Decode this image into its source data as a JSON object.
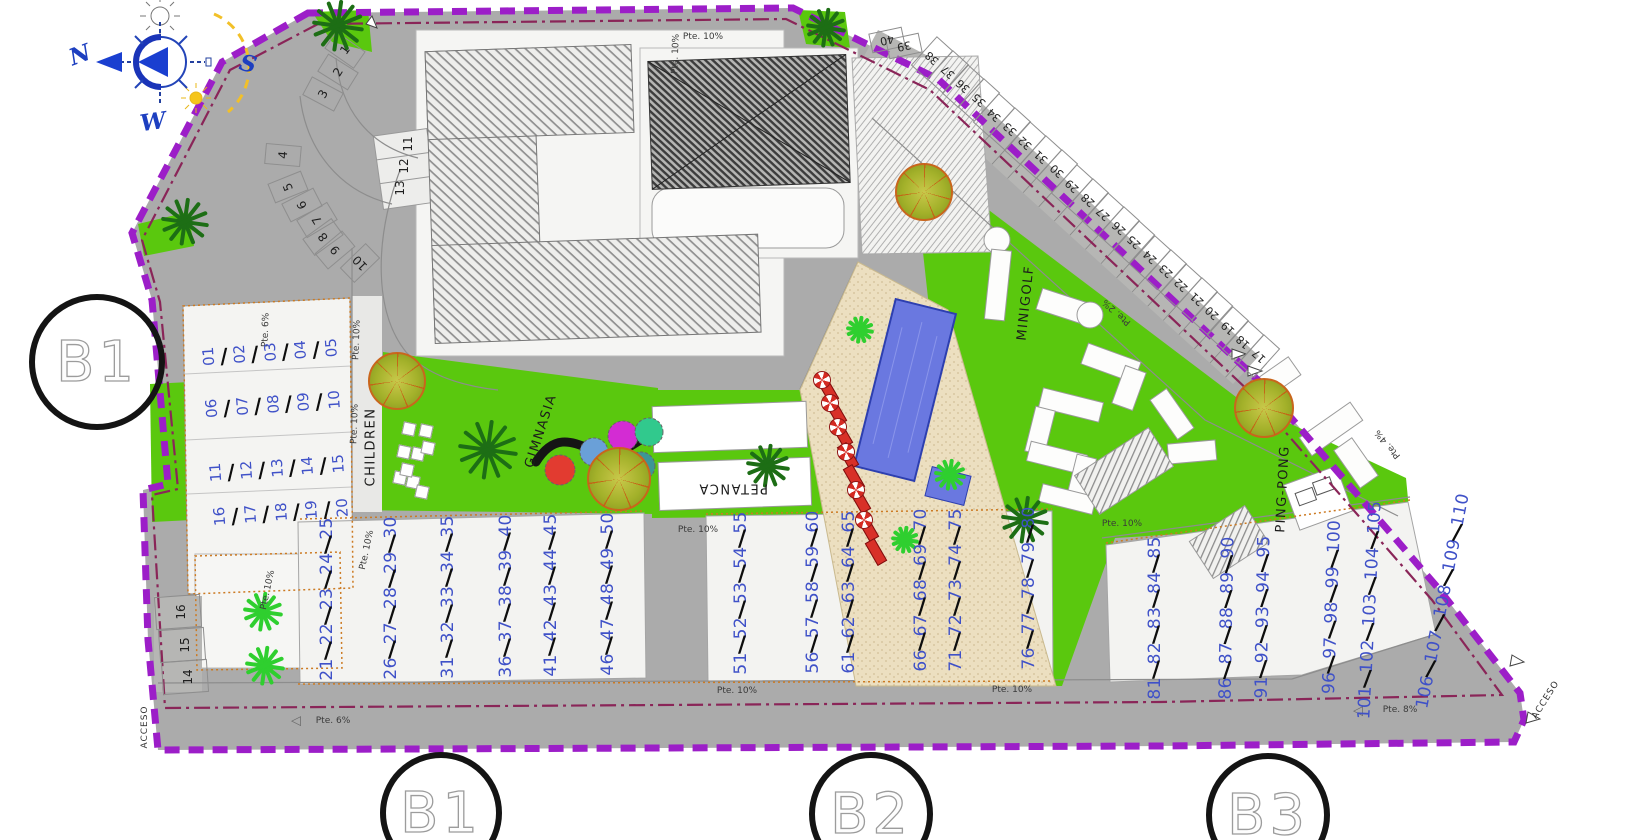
{
  "icons": {
    "slash": "/",
    "slope_arrow": "◁"
  },
  "colors": {
    "boundary": "#9c1ec8",
    "inner_line": "#8a2558",
    "numbers": "#3f51c8",
    "green": "#5ac80e",
    "road": "#ababab",
    "pool": "#6a78e0",
    "sand": "#ecdfc0",
    "accent_red": "#d83028"
  },
  "compass": {
    "letters": [
      {
        "text": "N",
        "x": 80,
        "y": 55,
        "rot": -20
      },
      {
        "text": "S",
        "x": 248,
        "y": 64,
        "rot": 15
      },
      {
        "text": "W",
        "x": 153,
        "y": 122,
        "rot": -8
      }
    ]
  },
  "block_circles": [
    {
      "label": "B1",
      "x": 97,
      "y": 362,
      "r": 62
    },
    {
      "label": "B1",
      "x": 441,
      "y": 813,
      "r": 55
    },
    {
      "label": "B2",
      "x": 871,
      "y": 814,
      "r": 56
    },
    {
      "label": "B3",
      "x": 1268,
      "y": 815,
      "r": 56
    }
  ],
  "area_labels": [
    {
      "text": "CHILDREN",
      "x": 371,
      "y": 447,
      "rot": -90
    },
    {
      "text": "GIMNASIA",
      "x": 541,
      "y": 431,
      "rot": -72
    },
    {
      "text": "PETANCA",
      "x": 733,
      "y": 488,
      "rot": 180
    },
    {
      "text": "MINIGOLF",
      "x": 1026,
      "y": 303,
      "rot": -84
    },
    {
      "text": "PING-PONG",
      "x": 1283,
      "y": 489,
      "rot": -87
    }
  ],
  "access_labels": [
    {
      "text": "ACCESO",
      "x": 145,
      "y": 727,
      "rot": -90
    },
    {
      "text": "ACCESO",
      "x": 1546,
      "y": 700,
      "rot": -58
    }
  ],
  "slope_labels": [
    {
      "text": "Pte. 6%",
      "x": 333,
      "y": 721,
      "rot": 0
    },
    {
      "text": "Pte. 8%",
      "x": 1400,
      "y": 710,
      "rot": 0
    },
    {
      "text": "Pte. 6%",
      "x": 266,
      "y": 330,
      "rot": -88
    },
    {
      "text": "Pte. 10%",
      "x": 676,
      "y": 54,
      "rot": -88
    },
    {
      "text": "Pte. 10%",
      "x": 703,
      "y": 37,
      "rot": 0
    },
    {
      "text": "Pte. 10%",
      "x": 357,
      "y": 340,
      "rot": -88
    },
    {
      "text": "Pte. 10%",
      "x": 355,
      "y": 424,
      "rot": -88
    },
    {
      "text": "Pte. 10%",
      "x": 268,
      "y": 590,
      "rot": -78
    },
    {
      "text": "Pte. 10%",
      "x": 367,
      "y": 550,
      "rot": -78
    },
    {
      "text": "Pte. 10%",
      "x": 698,
      "y": 530,
      "rot": 0
    },
    {
      "text": "Pte. 10%",
      "x": 1122,
      "y": 524,
      "rot": 0
    },
    {
      "text": "Pte. 10%",
      "x": 737,
      "y": 691,
      "rot": 0
    },
    {
      "text": "Pte. 10%",
      "x": 1012,
      "y": 690,
      "rot": 0
    },
    {
      "text": "Pte. 2%",
      "x": 1117,
      "y": 312,
      "rot": -138
    },
    {
      "text": "Pte. 4%",
      "x": 1388,
      "y": 444,
      "rot": -130
    }
  ],
  "slope_arrows": [
    {
      "x": 296,
      "y": 721,
      "rot": 0
    },
    {
      "x": 1358,
      "y": 711,
      "rot": 0
    }
  ],
  "left_building_rows": [
    {
      "nums": [
        "01",
        "02",
        "03",
        "04",
        "05"
      ],
      "x": 270,
      "y": 353,
      "rot": -4
    },
    {
      "nums": [
        "06",
        "07",
        "08",
        "09",
        "10"
      ],
      "x": 273,
      "y": 405,
      "rot": -4
    },
    {
      "nums": [
        "11",
        "12",
        "13",
        "14",
        "15"
      ],
      "x": 277,
      "y": 469,
      "rot": -4
    },
    {
      "nums": [
        "16",
        "17",
        "18",
        "19",
        "20"
      ],
      "x": 281,
      "y": 513,
      "rot": -4
    }
  ],
  "bottom_unit_groups": [
    {
      "nums": [
        "21",
        "22",
        "23",
        "24",
        "25"
      ],
      "x": 327,
      "y": 599,
      "rot": -90
    },
    {
      "nums": [
        "26",
        "27",
        "28",
        "29",
        "30"
      ],
      "x": 391,
      "y": 598,
      "rot": -90
    },
    {
      "nums": [
        "31",
        "32",
        "33",
        "34",
        "35"
      ],
      "x": 448,
      "y": 597,
      "rot": -90
    },
    {
      "nums": [
        "36",
        "37",
        "38",
        "39",
        "40"
      ],
      "x": 506,
      "y": 596,
      "rot": -90
    },
    {
      "nums": [
        "41",
        "42",
        "43",
        "44",
        "45"
      ],
      "x": 551,
      "y": 595,
      "rot": -90
    },
    {
      "nums": [
        "46",
        "47",
        "48",
        "49",
        "50"
      ],
      "x": 608,
      "y": 594,
      "rot": -90
    },
    {
      "nums": [
        "51",
        "52",
        "53",
        "54",
        "55"
      ],
      "x": 741,
      "y": 593,
      "rot": -90
    },
    {
      "nums": [
        "56",
        "57",
        "58",
        "59",
        "60"
      ],
      "x": 813,
      "y": 592,
      "rot": -90
    },
    {
      "nums": [
        "61",
        "62",
        "63",
        "64",
        "65"
      ],
      "x": 849,
      "y": 592,
      "rot": -90
    },
    {
      "nums": [
        "66",
        "67",
        "68",
        "69",
        "70"
      ],
      "x": 921,
      "y": 590,
      "rot": -90
    },
    {
      "nums": [
        "71",
        "72",
        "73",
        "74",
        "75"
      ],
      "x": 956,
      "y": 590,
      "rot": -90
    },
    {
      "nums": [
        "76",
        "77",
        "78",
        "79",
        "80"
      ],
      "x": 1029,
      "y": 588,
      "rot": -90
    },
    {
      "nums": [
        "81",
        "82",
        "83",
        "84",
        "85"
      ],
      "x": 1155,
      "y": 618,
      "rot": -90
    },
    {
      "nums": [
        "86",
        "87",
        "88",
        "89",
        "90"
      ],
      "x": 1227,
      "y": 618,
      "rot": -89
    },
    {
      "nums": [
        "91",
        "92",
        "93",
        "94",
        "95"
      ],
      "x": 1263,
      "y": 617,
      "rot": -89
    },
    {
      "nums": [
        "96",
        "97",
        "98",
        "99",
        "100"
      ],
      "x": 1332,
      "y": 607,
      "rot": -88
    },
    {
      "nums": [
        "101",
        "102",
        "103",
        "104",
        "105"
      ],
      "x": 1370,
      "y": 610,
      "rot": -87
    },
    {
      "nums": [
        "106",
        "107",
        "108",
        "109",
        "110"
      ],
      "x": 1443,
      "y": 601,
      "rot": -79
    }
  ],
  "parking": {
    "curve": [
      {
        "n": "1",
        "x": 345,
        "y": 50,
        "rot": -55
      },
      {
        "n": "2",
        "x": 338,
        "y": 72,
        "rot": -58
      },
      {
        "n": "3",
        "x": 323,
        "y": 94,
        "rot": -62
      },
      {
        "n": "4",
        "x": 283,
        "y": 155,
        "rot": -85
      },
      {
        "n": "5",
        "x": 288,
        "y": 187,
        "rot": -112
      },
      {
        "n": "6",
        "x": 302,
        "y": 205,
        "rot": -117
      },
      {
        "n": "7",
        "x": 317,
        "y": 220,
        "rot": -121
      },
      {
        "n": "8",
        "x": 323,
        "y": 237,
        "rot": -126
      },
      {
        "n": "9",
        "x": 335,
        "y": 250,
        "rot": -130
      },
      {
        "n": "10",
        "x": 360,
        "y": 263,
        "rot": -134
      }
    ],
    "island": [
      {
        "n": "11",
        "x": 408,
        "y": 144
      },
      {
        "n": "12",
        "x": 404,
        "y": 166
      },
      {
        "n": "13",
        "x": 400,
        "y": 188
      }
    ],
    "corner": [
      {
        "n": "16",
        "x": 181,
        "y": 612
      },
      {
        "n": "15",
        "x": 185,
        "y": 645
      },
      {
        "n": "14",
        "x": 188,
        "y": 677
      }
    ],
    "diagonal": {
      "nums": [
        "17",
        "18",
        "19",
        "20",
        "21",
        "22",
        "23",
        "24",
        "25",
        "26",
        "27",
        "28",
        "29",
        "30",
        "31",
        "32",
        "33",
        "34",
        "35",
        "36",
        "37",
        "38"
      ],
      "x0": 1259,
      "y0": 356,
      "dx": -15.57,
      "dy": -14.2,
      "rot": -138,
      "cell_rot": 42
    },
    "diagonal_extra": [
      {
        "n": "39",
        "x": 904,
        "y": 46,
        "rot": 168
      },
      {
        "n": "40",
        "x": 887,
        "y": 40,
        "rot": 168
      }
    ]
  },
  "landscape": {
    "trees": [
      {
        "x": 397,
        "y": 381,
        "r": 27
      },
      {
        "x": 619,
        "y": 479,
        "r": 30
      },
      {
        "x": 924,
        "y": 192,
        "r": 27
      },
      {
        "x": 1264,
        "y": 408,
        "r": 28
      }
    ],
    "palms_dark": [
      {
        "x": 338,
        "y": 26,
        "r": 26
      },
      {
        "x": 826,
        "y": 28,
        "r": 20
      },
      {
        "x": 185,
        "y": 222,
        "r": 24
      },
      {
        "x": 488,
        "y": 450,
        "r": 30
      },
      {
        "x": 768,
        "y": 466,
        "r": 22
      },
      {
        "x": 1025,
        "y": 520,
        "r": 24
      }
    ],
    "palms_bright": [
      {
        "x": 263,
        "y": 612,
        "r": 20
      },
      {
        "x": 265,
        "y": 666,
        "r": 20
      },
      {
        "x": 860,
        "y": 330,
        "r": 14
      },
      {
        "x": 950,
        "y": 475,
        "r": 16
      },
      {
        "x": 905,
        "y": 540,
        "r": 14
      }
    ],
    "children_squares": [
      [
        409,
        429
      ],
      [
        426,
        431
      ],
      [
        404,
        452
      ],
      [
        418,
        454
      ],
      [
        428,
        448
      ],
      [
        400,
        478
      ],
      [
        413,
        482
      ],
      [
        407,
        470
      ],
      [
        422,
        492
      ]
    ],
    "gym_circles": [
      {
        "x": 560,
        "y": 470,
        "r": 15,
        "color": "#e23b30"
      },
      {
        "x": 594,
        "y": 452,
        "r": 14,
        "color": "#6aa0d8"
      },
      {
        "x": 623,
        "y": 436,
        "r": 15,
        "color": "#d32cd3"
      },
      {
        "x": 649,
        "y": 432,
        "r": 14,
        "color": "#31c98d"
      },
      {
        "x": 641,
        "y": 466,
        "r": 14,
        "color": "#3d9696"
      },
      {
        "x": 609,
        "y": 485,
        "r": 13,
        "color": "#e3d35a"
      }
    ],
    "loungers": [
      [
        828,
        390
      ],
      [
        836,
        412
      ],
      [
        842,
        434
      ],
      [
        848,
        456
      ],
      [
        854,
        478
      ],
      [
        860,
        500
      ],
      [
        868,
        528
      ],
      [
        876,
        552
      ]
    ],
    "parasols": [
      [
        822,
        380
      ],
      [
        830,
        403
      ],
      [
        838,
        427
      ],
      [
        846,
        452
      ],
      [
        856,
        490
      ],
      [
        864,
        520
      ]
    ]
  }
}
